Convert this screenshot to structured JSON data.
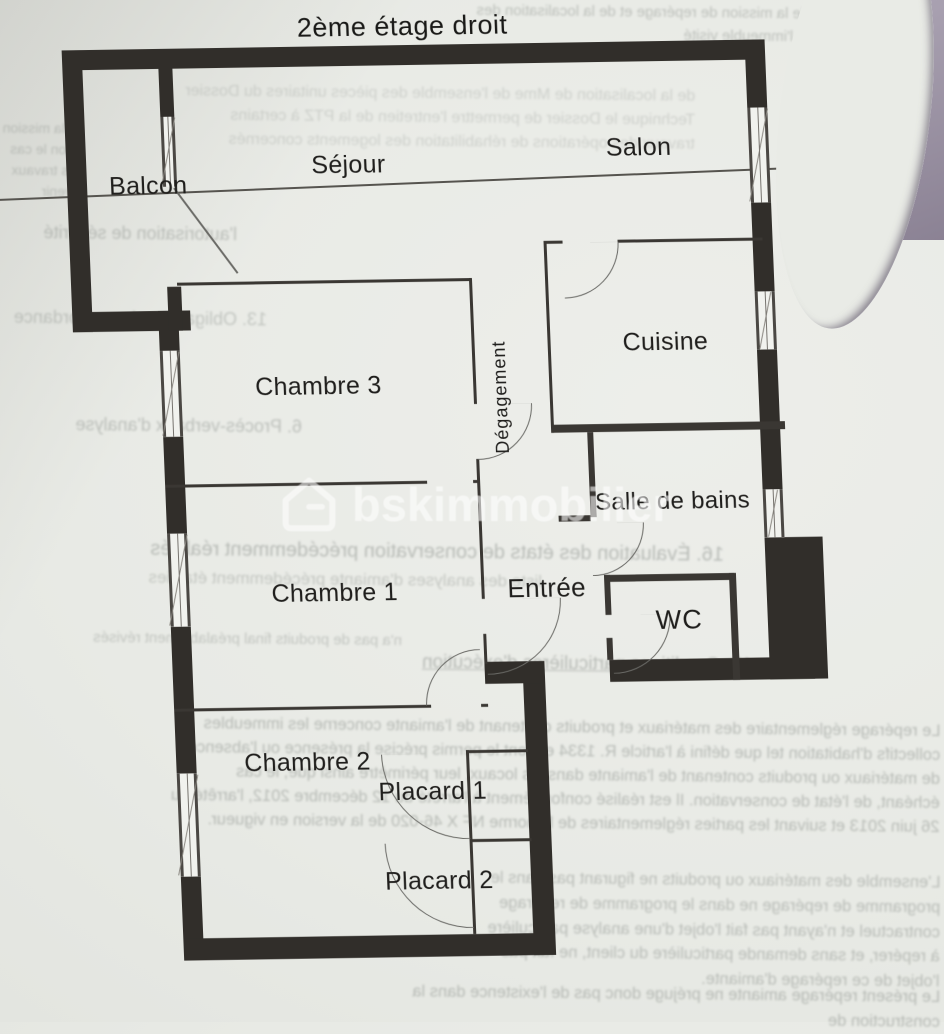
{
  "title": "2ème étage droit",
  "watermark": {
    "text": "bskimmobilier",
    "logo": "house-g-logo"
  },
  "rooms": {
    "balcon": "Balcon",
    "sejour": "Séjour",
    "salon": "Salon",
    "cuisine": "Cuisine",
    "chambre3": "Chambre 3",
    "degagement": "Dégagement",
    "salle_de_bains": "Salle de bains",
    "chambre1": "Chambre 1",
    "entree": "Entrée",
    "wc": "WC",
    "chambre2": "Chambre 2",
    "placard1": "Placard 1",
    "placard2": "Placard 2"
  },
  "bleedthrough": {
    "g1": "dont le cadre de la mission de repérage et de la localisation des matériaux dans l'immeuble visité",
    "g2": "de la localisation de Mme de l'ensemble des pièces unitaires du Dossier Technique le Dossier de permettre l'entretien de la PTZ à certains travaux des opérations de réhabilitation des logements concernés",
    "g3": "de la mission selon le cas des travaux à venir",
    "g4": "l'autorisation de sécurité",
    "g5": "13. Obligations de concordance",
    "g6": "6. Procès-verbaux d'analyse",
    "g7": "16. Évaluation des états de conservation précédemment réalisés",
    "g7b": "liste des analyses d'amiante précédemment établies",
    "g8": "n'a pas de produits final préalablement révisés",
    "g9": "17. Conditions particulières d'exécution",
    "g10": "Le repérage réglementaire des matériaux et produits contenant de l'amiante concerne les immeubles collectifs d'habitation tel que défini à l'article R. 1334 et dont le permis précise la présence ou l'absence de matériaux ou produits contenant de l'amiante dans les locaux, leur périmètre ainsi que, le cas échéant, de l'état de conservation. Il est réalisé conformément à l'arrêté du 12 décembre 2012, l'arrêté du 26 juin 2013 et suivant les parties réglementaires de la norme NF X 46-020 de la version en vigueur.",
    "g11": "L'ensemble des matériaux ou produits ne figurant pas dans le programme de repérage ne dans le programme de repérage contractuel et n'ayant pas fait l'objet d'une analyse particulière à repérer, et sans demande particulière du client, ne fait pas l'objet de ce repérage d'amiante.",
    "g12": "Le présent repérage amiante ne préjuge donc pas de l'existence dans la construction de"
  },
  "colors": {
    "paper": "#e8eae5",
    "wall": "#312e2a",
    "backdrop_purple": "#9b92a3",
    "label_ink": "#1f1e1c",
    "ghost_ink": "#878c87",
    "watermark": "#ffffff"
  }
}
